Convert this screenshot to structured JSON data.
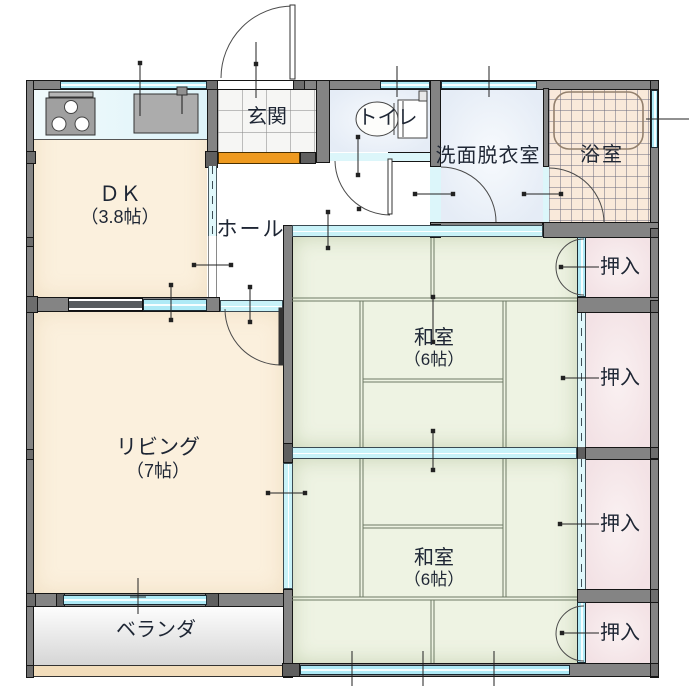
{
  "plan": {
    "rooms": {
      "dk": {
        "name": "ＤＫ",
        "size": "（3.8帖）"
      },
      "entrance": {
        "name": "玄関"
      },
      "hall": {
        "name": "ホール"
      },
      "toilet": {
        "name": "トイレ"
      },
      "washroom": {
        "name": "洗面脱衣室"
      },
      "bathroom": {
        "name": "浴室"
      },
      "japanese_room_north": {
        "name": "和室",
        "size": "（6帖）"
      },
      "japanese_room_south": {
        "name": "和室",
        "size": "（6帖）"
      },
      "living": {
        "name": "リビング",
        "size": "（7帖）"
      },
      "veranda": {
        "name": "ベランダ"
      },
      "closet_north": {
        "name": "押入"
      },
      "closet_upper": {
        "name": "押入"
      },
      "closet_lower": {
        "name": "押入"
      },
      "closet_south": {
        "name": "押入"
      }
    },
    "palette": {
      "wall_gray": "#848484",
      "window_cyan": "#aeeaf6",
      "slider_cyan": "#c8f2f8",
      "tatami_green": "#eef3e3",
      "flooring_cream": "#fbf0dd",
      "closet_pink": "#f3e2e5",
      "bath_peach": "#f9e9da",
      "wet_area_blue": "#e5ecf6",
      "entrance_step_orange": "#ee9a20",
      "veranda_gray": "#d5d5d5",
      "sill_tan": "#f2ddbb"
    }
  }
}
